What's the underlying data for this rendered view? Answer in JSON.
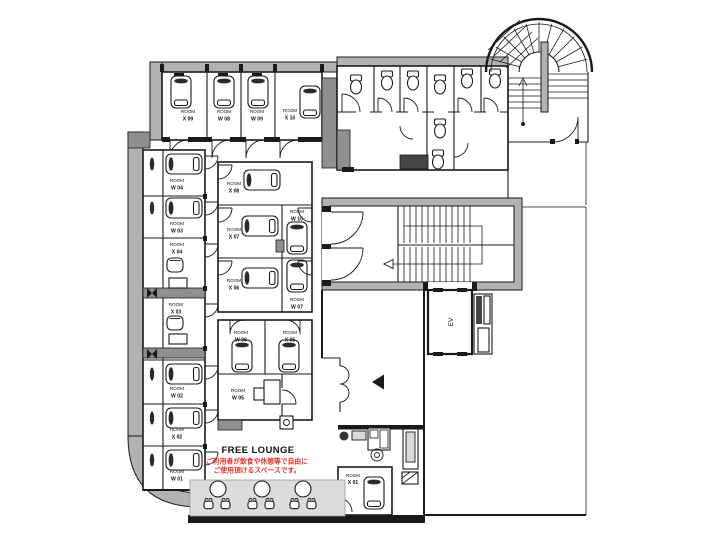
{
  "plan": {
    "room_prefix": "ROOM",
    "rooms": {
      "top_row": [
        "X 09",
        "W 08",
        "W 09",
        "X 10"
      ],
      "left_column": [
        "W 04",
        "W 03",
        "X 04",
        "X 03",
        "W 02",
        "X 02",
        "W 01"
      ],
      "center_block": [
        "X 08",
        "X 07",
        "X 06",
        "W 10",
        "W 07"
      ],
      "lower_center": [
        "W 06",
        "X 05",
        "W 05"
      ],
      "bottom": [
        "X 01"
      ]
    },
    "lounge": {
      "title": "FREE LOUNGE",
      "note_line1": "ご利用者が飲食や休憩等で自由に",
      "note_line2": "ご使用頂けるスペースです。"
    },
    "elevator": {
      "label": "EV"
    },
    "colors": {
      "wall_gray": "#b2b2b2",
      "column_gray": "#8f8f8f",
      "line_black": "#1a1a1a",
      "note_red": "#e8332a",
      "furniture_gray": "#d9d9d9"
    }
  }
}
